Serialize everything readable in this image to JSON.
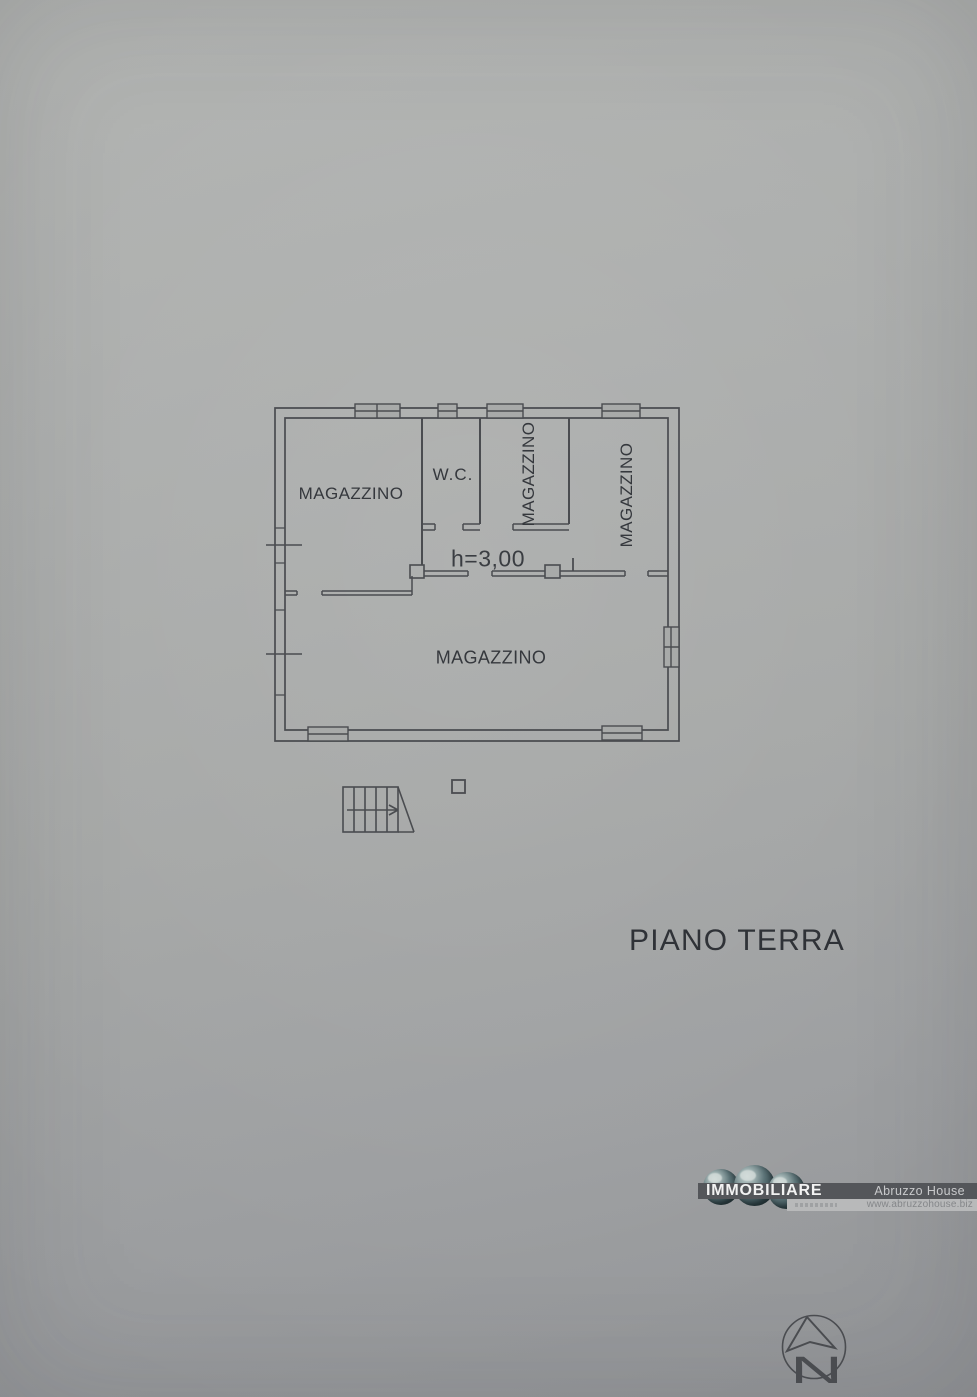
{
  "page": {
    "floor_title": "PIANO TERRA"
  },
  "plan": {
    "height_note": "h=3,00",
    "north_label": "N",
    "rooms": [
      {
        "label": "MAGAZZINO",
        "position": "top-left",
        "orientation": "horizontal"
      },
      {
        "label": "W.C.",
        "position": "top-middle",
        "orientation": "horizontal"
      },
      {
        "label": "MAGAZZINO",
        "position": "top-center",
        "orientation": "vertical"
      },
      {
        "label": "MAGAZZINO",
        "position": "top-right",
        "orientation": "vertical"
      },
      {
        "label": "MAGAZZINO",
        "position": "bottom-large",
        "orientation": "horizontal"
      }
    ]
  },
  "logo": {
    "brand": "IMMOBILIARE",
    "agency": "Abruzzo House",
    "website": "www.abruzzohouse.biz"
  },
  "colors": {
    "ink": "#4a4c50",
    "text": "#35383d",
    "logo_bar": "#54565a",
    "logo_brand_text": "#f2f2f2",
    "logo_strip": "#b8b9ba"
  }
}
